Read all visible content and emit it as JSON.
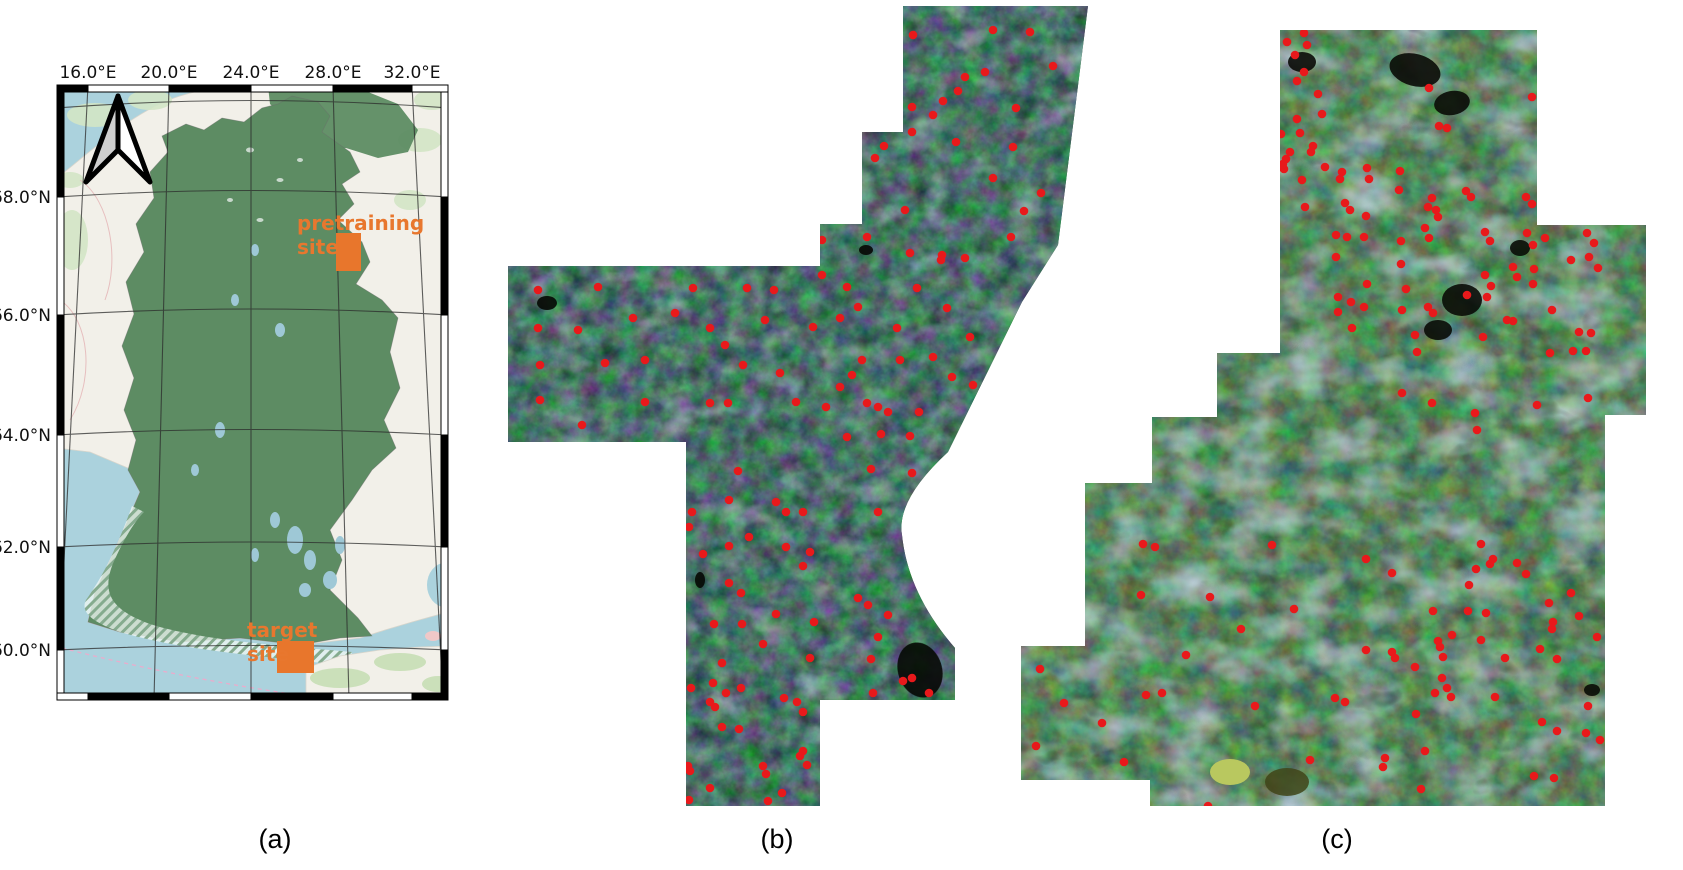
{
  "figure": {
    "caption_a": "(a)",
    "caption_b": "(b)",
    "caption_c": "(c)"
  },
  "map": {
    "lon_labels": [
      "16.0°E",
      "20.0°E",
      "24.0°E",
      "28.0°E",
      "32.0°E"
    ],
    "lat_labels": [
      "68.0°N",
      "66.0°N",
      "64.0°N",
      "62.0°N",
      "60.0°N"
    ],
    "pretraining_site": {
      "line1": "pretraining",
      "line2": "site"
    },
    "target_site": {
      "line1": "target",
      "line2": "site"
    },
    "site_color": "#e8762c",
    "finland_color": "#5d8c63",
    "sea_color": "#abd2dd",
    "land_color": "#f2f0e9"
  },
  "dot_color": "#e8191b",
  "panel_b": {
    "dots": [
      [
        913,
        35
      ],
      [
        993,
        30
      ],
      [
        1030,
        32
      ],
      [
        1053,
        66
      ],
      [
        985,
        72
      ],
      [
        965,
        77
      ],
      [
        958,
        91
      ],
      [
        943,
        101
      ],
      [
        912,
        107
      ],
      [
        933,
        115
      ],
      [
        1016,
        108
      ],
      [
        912,
        132
      ],
      [
        884,
        146
      ],
      [
        875,
        158
      ],
      [
        956,
        142
      ],
      [
        1013,
        147
      ],
      [
        993,
        178
      ],
      [
        1041,
        193
      ],
      [
        1024,
        211
      ],
      [
        905,
        210
      ],
      [
        867,
        237
      ],
      [
        942,
        255
      ],
      [
        965,
        258
      ],
      [
        1011,
        237
      ],
      [
        822,
        240
      ],
      [
        538,
        290
      ],
      [
        598,
        287
      ],
      [
        633,
        318
      ],
      [
        693,
        288
      ],
      [
        675,
        313
      ],
      [
        710,
        328
      ],
      [
        747,
        288
      ],
      [
        774,
        290
      ],
      [
        725,
        345
      ],
      [
        743,
        365
      ],
      [
        538,
        328
      ],
      [
        578,
        330
      ],
      [
        540,
        365
      ],
      [
        605,
        363
      ],
      [
        645,
        360
      ],
      [
        540,
        400
      ],
      [
        645,
        402
      ],
      [
        710,
        403
      ],
      [
        582,
        425
      ],
      [
        765,
        320
      ],
      [
        780,
        373
      ],
      [
        813,
        327
      ],
      [
        822,
        275
      ],
      [
        847,
        287
      ],
      [
        858,
        307
      ],
      [
        840,
        318
      ],
      [
        862,
        360
      ],
      [
        852,
        375
      ],
      [
        840,
        387
      ],
      [
        867,
        403
      ],
      [
        878,
        407
      ],
      [
        897,
        328
      ],
      [
        910,
        253
      ],
      [
        941,
        260
      ],
      [
        917,
        288
      ],
      [
        947,
        308
      ],
      [
        970,
        337
      ],
      [
        933,
        357
      ],
      [
        952,
        377
      ],
      [
        973,
        385
      ],
      [
        900,
        360
      ],
      [
        888,
        412
      ],
      [
        728,
        403
      ],
      [
        796,
        402
      ],
      [
        826,
        407
      ],
      [
        919,
        412
      ],
      [
        847,
        437
      ],
      [
        881,
        434
      ],
      [
        910,
        436
      ],
      [
        738,
        471
      ],
      [
        871,
        469
      ],
      [
        912,
        473
      ],
      [
        692,
        512
      ],
      [
        729,
        500
      ],
      [
        776,
        502
      ],
      [
        786,
        512
      ],
      [
        803,
        512
      ],
      [
        878,
        512
      ],
      [
        689,
        527
      ],
      [
        729,
        546
      ],
      [
        749,
        537
      ],
      [
        786,
        547
      ],
      [
        810,
        552
      ],
      [
        703,
        554
      ],
      [
        729,
        583
      ],
      [
        741,
        593
      ],
      [
        803,
        566
      ],
      [
        858,
        598
      ],
      [
        868,
        605
      ],
      [
        878,
        637
      ],
      [
        888,
        615
      ],
      [
        814,
        622
      ],
      [
        776,
        614
      ],
      [
        763,
        644
      ],
      [
        742,
        624
      ],
      [
        714,
        624
      ],
      [
        722,
        663
      ],
      [
        741,
        688
      ],
      [
        715,
        707
      ],
      [
        691,
        688
      ],
      [
        797,
        702
      ],
      [
        810,
        658
      ],
      [
        871,
        659
      ],
      [
        912,
        678
      ],
      [
        713,
        683
      ],
      [
        726,
        693
      ],
      [
        710,
        702
      ],
      [
        784,
        698
      ],
      [
        873,
        693
      ],
      [
        929,
        693
      ],
      [
        803,
        751
      ],
      [
        763,
        766
      ],
      [
        807,
        765
      ],
      [
        688,
        766
      ],
      [
        710,
        788
      ],
      [
        689,
        800
      ],
      [
        768,
        801
      ],
      [
        782,
        793
      ],
      [
        690,
        771
      ],
      [
        766,
        774
      ],
      [
        800,
        756
      ],
      [
        722,
        727
      ],
      [
        739,
        729
      ],
      [
        803,
        712
      ],
      [
        903,
        681
      ]
    ]
  },
  "panel_c": {
    "dots": [
      [
        1287,
        42
      ],
      [
        1304,
        33
      ],
      [
        1307,
        45
      ],
      [
        1295,
        55
      ],
      [
        1304,
        72
      ],
      [
        1297,
        81
      ],
      [
        1318,
        94
      ],
      [
        1322,
        114
      ],
      [
        1429,
        88
      ],
      [
        1297,
        119
      ],
      [
        1281,
        134
      ],
      [
        1300,
        133
      ],
      [
        1311,
        152
      ],
      [
        1290,
        152
      ],
      [
        1284,
        169
      ],
      [
        1302,
        180
      ],
      [
        1367,
        168
      ],
      [
        1369,
        179
      ],
      [
        1400,
        171
      ],
      [
        1399,
        190
      ],
      [
        1439,
        126
      ],
      [
        1447,
        128
      ],
      [
        1471,
        197
      ],
      [
        1532,
        204
      ],
      [
        1532,
        97
      ],
      [
        1340,
        179
      ],
      [
        1350,
        210
      ],
      [
        1366,
        216
      ],
      [
        1336,
        235
      ],
      [
        1347,
        237
      ],
      [
        1364,
        237
      ],
      [
        1401,
        241
      ],
      [
        1428,
        207
      ],
      [
        1438,
        217
      ],
      [
        1533,
        245
      ],
      [
        1490,
        241
      ],
      [
        1336,
        257
      ],
      [
        1401,
        264
      ],
      [
        1429,
        238
      ],
      [
        1367,
        284
      ],
      [
        1406,
        289
      ],
      [
        1533,
        284
      ],
      [
        1594,
        243
      ],
      [
        1598,
        268
      ],
      [
        1517,
        277
      ],
      [
        1491,
        286
      ],
      [
        1338,
        297
      ],
      [
        1351,
        302
      ],
      [
        1338,
        312
      ],
      [
        1352,
        328
      ],
      [
        1364,
        307
      ],
      [
        1402,
        310
      ],
      [
        1428,
        307
      ],
      [
        1325,
        167
      ],
      [
        1342,
        172
      ],
      [
        1345,
        203
      ],
      [
        1305,
        207
      ],
      [
        1286,
        159
      ],
      [
        1283,
        164
      ],
      [
        1313,
        146
      ],
      [
        1432,
        198
      ],
      [
        1436,
        210
      ],
      [
        1425,
        228
      ],
      [
        1466,
        191
      ],
      [
        1485,
        232
      ],
      [
        1526,
        197
      ],
      [
        1527,
        233
      ],
      [
        1587,
        233
      ],
      [
        1545,
        238
      ],
      [
        1589,
        257
      ],
      [
        1571,
        260
      ],
      [
        1513,
        267
      ],
      [
        1534,
        269
      ],
      [
        1485,
        275
      ],
      [
        1513,
        321
      ],
      [
        1433,
        313
      ],
      [
        1467,
        295
      ],
      [
        1487,
        297
      ],
      [
        1552,
        310
      ],
      [
        1579,
        332
      ],
      [
        1591,
        333
      ],
      [
        1483,
        337
      ],
      [
        1507,
        320
      ],
      [
        1415,
        335
      ],
      [
        1417,
        352
      ],
      [
        1550,
        353
      ],
      [
        1573,
        351
      ],
      [
        1586,
        351
      ],
      [
        1432,
        403
      ],
      [
        1402,
        393
      ],
      [
        1537,
        405
      ],
      [
        1588,
        398
      ],
      [
        1475,
        413
      ],
      [
        1477,
        430
      ],
      [
        1143,
        544
      ],
      [
        1155,
        547
      ],
      [
        1272,
        545
      ],
      [
        1366,
        559
      ],
      [
        1392,
        573
      ],
      [
        1481,
        544
      ],
      [
        1493,
        559
      ],
      [
        1526,
        574
      ],
      [
        1552,
        629
      ],
      [
        1579,
        616
      ],
      [
        1557,
        659
      ],
      [
        1141,
        595
      ],
      [
        1210,
        597
      ],
      [
        1241,
        629
      ],
      [
        1294,
        609
      ],
      [
        1366,
        650
      ],
      [
        1392,
        652
      ],
      [
        1438,
        641
      ],
      [
        1447,
        688
      ],
      [
        1421,
        789
      ],
      [
        1385,
        758
      ],
      [
        1335,
        698
      ],
      [
        1162,
        693
      ],
      [
        1146,
        695
      ],
      [
        1040,
        669
      ],
      [
        1036,
        746
      ],
      [
        1208,
        806
      ],
      [
        1345,
        702
      ],
      [
        1476,
        569
      ],
      [
        1490,
        564
      ],
      [
        1517,
        563
      ],
      [
        1469,
        585
      ],
      [
        1433,
        611
      ],
      [
        1468,
        611
      ],
      [
        1486,
        613
      ],
      [
        1549,
        603
      ],
      [
        1571,
        593
      ],
      [
        1597,
        637
      ],
      [
        1553,
        622
      ],
      [
        1452,
        635
      ],
      [
        1481,
        640
      ],
      [
        1440,
        647
      ],
      [
        1443,
        657
      ],
      [
        1395,
        658
      ],
      [
        1415,
        667
      ],
      [
        1442,
        678
      ],
      [
        1435,
        693
      ],
      [
        1451,
        697
      ],
      [
        1495,
        697
      ],
      [
        1505,
        658
      ],
      [
        1540,
        649
      ],
      [
        1542,
        722
      ],
      [
        1557,
        731
      ],
      [
        1588,
        706
      ],
      [
        1586,
        733
      ],
      [
        1416,
        714
      ],
      [
        1425,
        751
      ],
      [
        1383,
        767
      ],
      [
        1534,
        776
      ],
      [
        1554,
        778
      ],
      [
        1600,
        740
      ],
      [
        1310,
        760
      ],
      [
        1255,
        706
      ],
      [
        1186,
        655
      ],
      [
        1102,
        723
      ],
      [
        1124,
        762
      ],
      [
        1064,
        703
      ]
    ]
  }
}
